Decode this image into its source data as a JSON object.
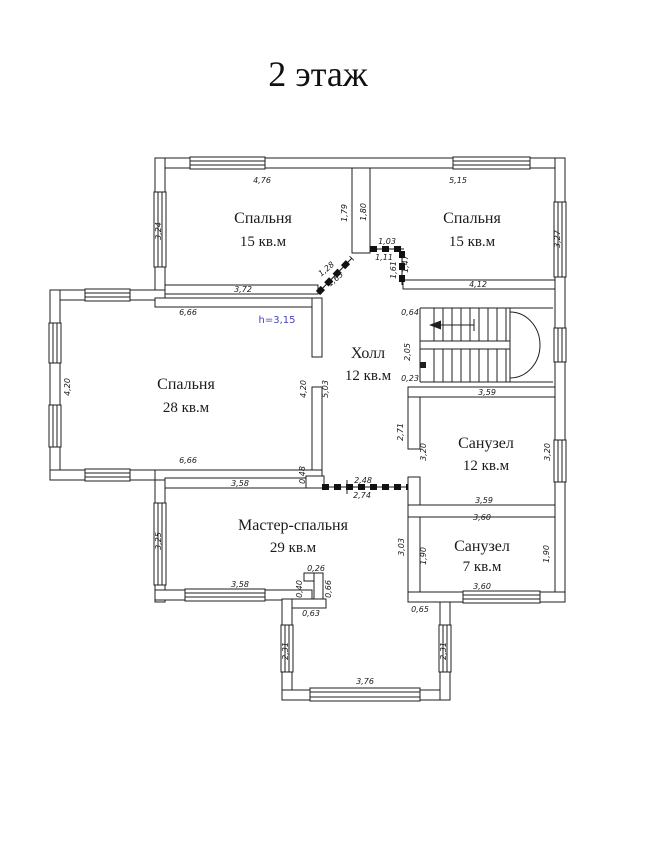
{
  "title": "2 этаж",
  "colors": {
    "walls": "#1f1f1f",
    "dimension_text": "#1b1b1b",
    "height_note_text": "#4646b4",
    "background": "#ffffff"
  },
  "rooms": {
    "bedroom_top_left": {
      "name": "Спальня",
      "area": "15 кв.м"
    },
    "bedroom_top_right": {
      "name": "Спальня",
      "area": "15 кв.м"
    },
    "bedroom_left": {
      "name": "Спальня",
      "area": "28 кв.м",
      "ceiling_height": "h=3,15"
    },
    "hall": {
      "name": "Холл",
      "area": "12 кв.м"
    },
    "bathroom_large": {
      "name": "Санузел",
      "area": "12 кв.м"
    },
    "master_bedroom": {
      "name": "Мастер-спальня",
      "area": "29 кв.м"
    },
    "bathroom_small": {
      "name": "Санузел",
      "area": "7 кв.м"
    }
  },
  "dimensions": {
    "tl_top": "4,76",
    "tl_left": "3,24",
    "tl_right": "1,79",
    "tl_bottom": "3,72",
    "tl_diag_a": "1,28",
    "tl_diag_b": "1,63",
    "tr_top": "5,15",
    "tr_left": "1,80",
    "tr_right": "3,27",
    "tr_bottom": "4,12",
    "door_top_a": "1,03",
    "door_top_b": "1,11",
    "door_side_a": "1,61",
    "door_side_b": "1,47",
    "b28_top": "6,66",
    "b28_left": "4,20",
    "b28_right": "4,20",
    "b28_hall": "5,03",
    "b28_bottom": "6,66",
    "stairs_top": "0,64",
    "stairs_mid": "2,05",
    "stairs_bottom": "0,23",
    "hall_door_a": "2,48",
    "hall_door_b": "2,74",
    "s12_top": "3,59",
    "s12_bottom": "3,59",
    "s12_left_out": "2,71",
    "s12_left_in": "3,20",
    "s12_right": "3,20",
    "m_top": "3,58",
    "m_step": "0,48",
    "m_left": "3,25",
    "m_bottom": "3,58",
    "m_jog_a": "0,40",
    "m_jog_b": "0,26",
    "m_jog_c": "0,66",
    "m_jog_d": "0,63",
    "s7_top": "3,60",
    "s7_bottom": "3,60",
    "s7_left_out": "3,03",
    "s7_left_in": "1,90",
    "s7_right": "1,90",
    "s7_corner": "0,65",
    "bal_left": "2,31",
    "bal_right": "2,31",
    "bal_bottom": "3,76"
  }
}
